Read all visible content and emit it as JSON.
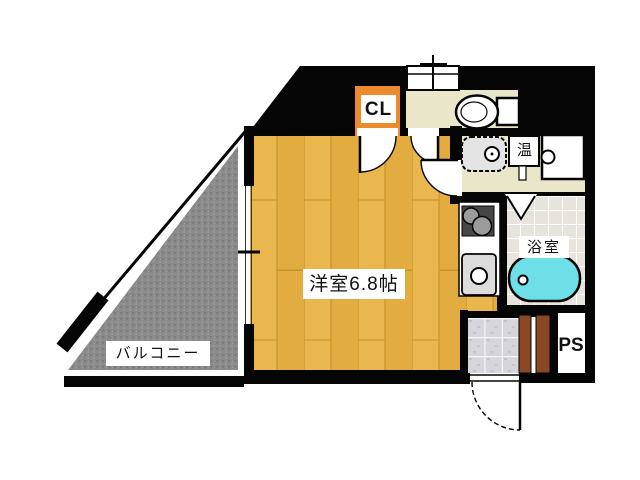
{
  "floor_plan": {
    "labels": {
      "western_room": "洋室6.8帖",
      "balcony": "バルコニー",
      "bathroom": "浴室",
      "closet": "CL",
      "pipe_space": "PS",
      "water_heater": "温"
    },
    "rooms": [
      {
        "name": "western-room",
        "label": "洋室6.8帖"
      },
      {
        "name": "balcony",
        "label": "バルコニー"
      },
      {
        "name": "bathroom",
        "label": "浴室"
      },
      {
        "name": "closet",
        "label": "CL"
      },
      {
        "name": "pipe-space",
        "label": "PS"
      },
      {
        "name": "water-heater",
        "label": "温"
      }
    ],
    "colors": {
      "wood_floor": "#EAB64E",
      "balcony_gray": "#8A8A8A",
      "cream_floor": "#EAE6CA",
      "closet_orange": "#EC8B2D",
      "bathtub_cyan": "#6EDFE7",
      "bath_tile": "#E6E4DC",
      "entrance_tile": "#D6D6DA",
      "door_brown": "#8A4723",
      "wall_black": "#050505"
    }
  }
}
